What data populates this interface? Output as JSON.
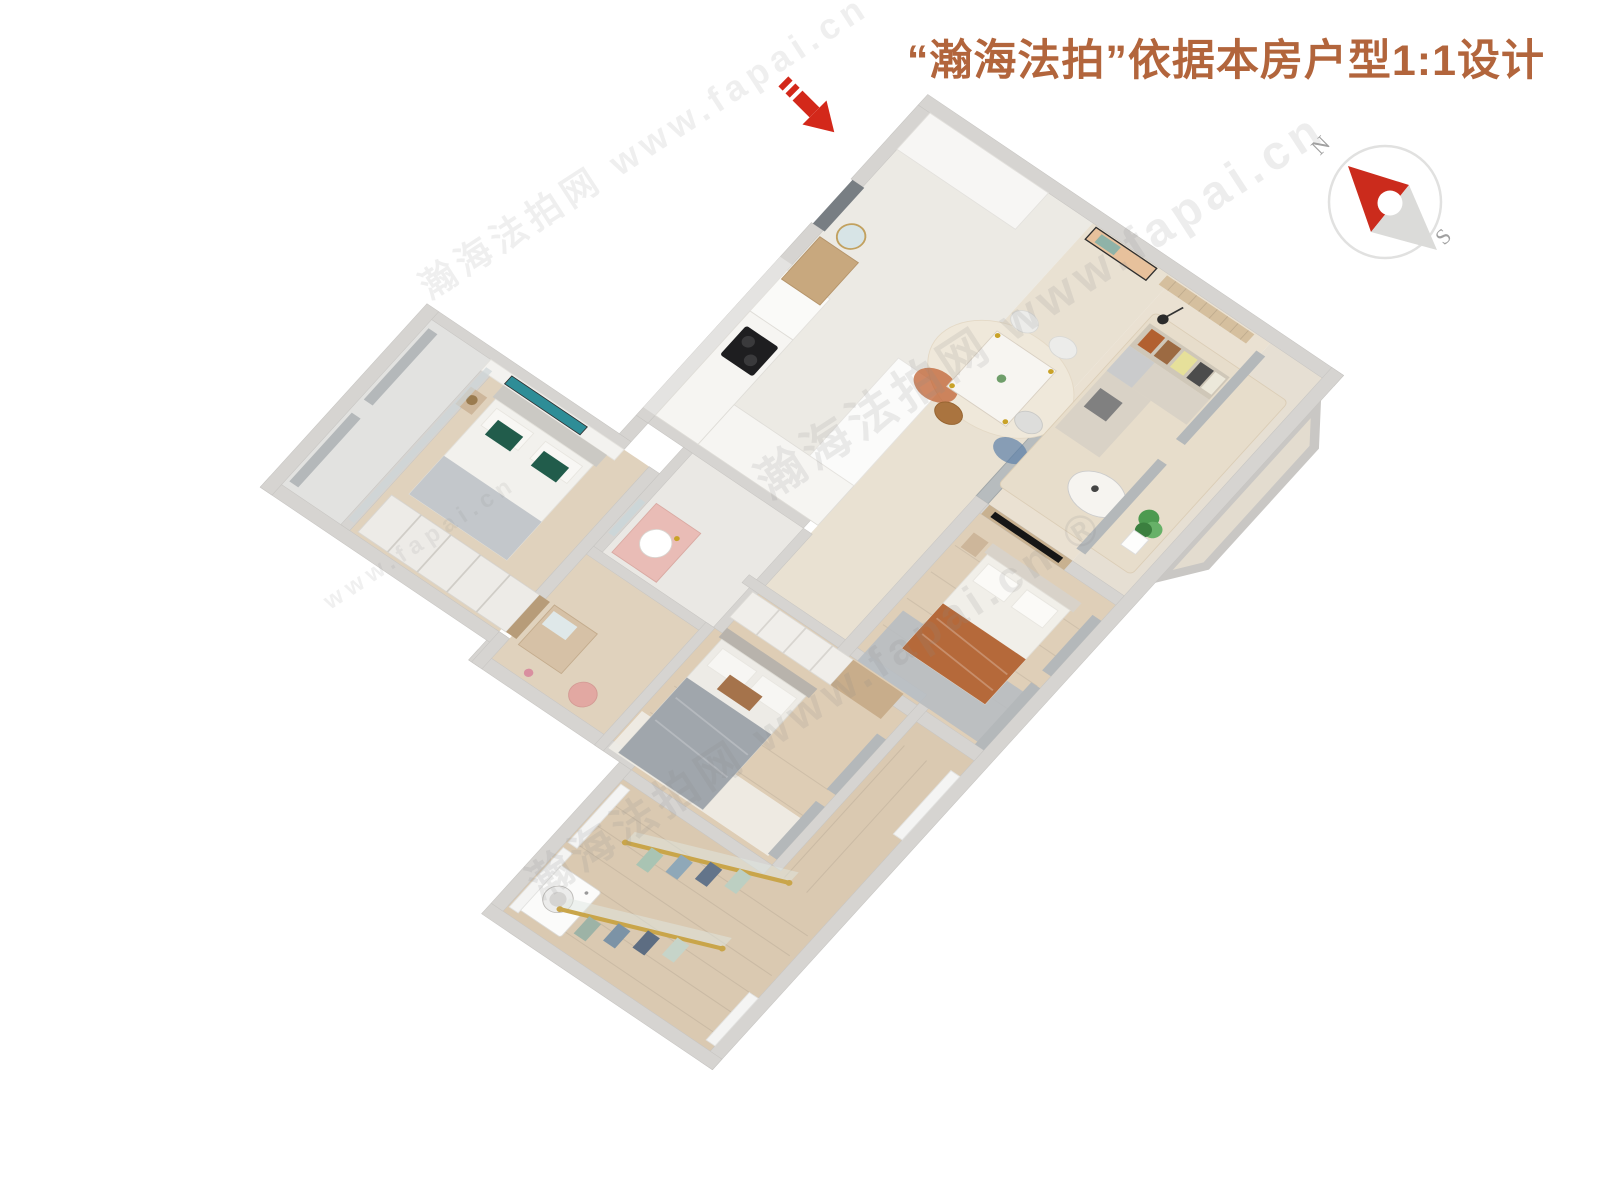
{
  "title": {
    "text": "“瀚海法拍”依据本房户型1:1设计",
    "color": "#b2653c"
  },
  "entrance": {
    "arrow_color": "#d3281a"
  },
  "compass": {
    "north": "N",
    "south": "S",
    "needle_red": "#cb2b1c",
    "needle_gray": "#dbdbd9",
    "ring": "#e1e1e0",
    "label_color": "#a0a0a0"
  },
  "watermark": {
    "brand": "瀚海法拍网",
    "url": "www.fapai.cn",
    "brand_url": "瀚海法拍网 www.fapai.cn",
    "brand_url_reg": "瀚海法拍网 www.fapai.cn ®",
    "url_only": "www.fapai.cn"
  },
  "palette": {
    "wall": "#d6d4d1",
    "wood_floor": "#dccbb3",
    "tile_floor": "#eceae4",
    "sofa": "#d8d1c5",
    "accent_orange": "#b5693a",
    "accent_green_pillow": "#215c4b",
    "gold": "#c9a54a"
  }
}
